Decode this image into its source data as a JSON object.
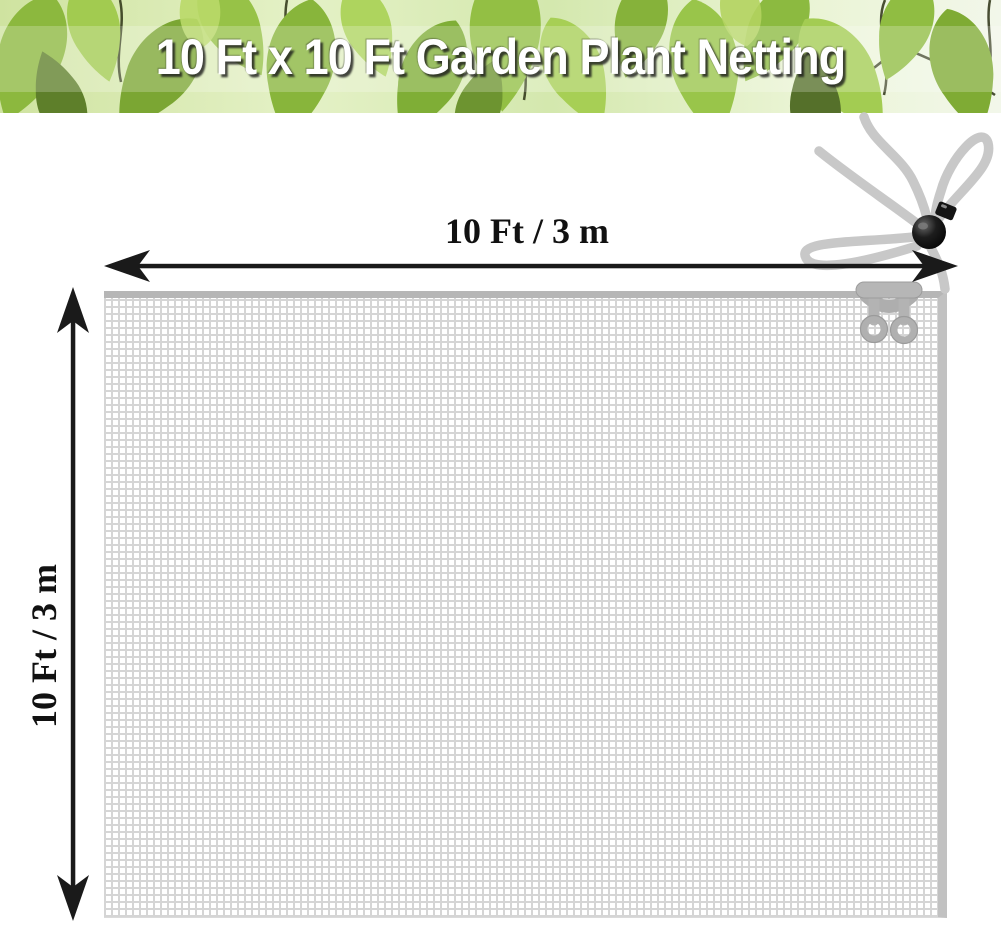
{
  "header": {
    "title": "10 Ft x 10 Ft Garden Plant Netting"
  },
  "dimensions": {
    "width_label": "10 Ft / 3 m",
    "height_label": "10 Ft / 3 m"
  },
  "icons": {
    "cord_lock": "cord-lock-toggle-icon",
    "net_clip": "double-ring-clip-icon",
    "tie_rope": "tie-rope-bow-icon",
    "width_arrow": "double-headed-horizontal-arrow",
    "height_arrow": "double-headed-vertical-arrow"
  },
  "colors": {
    "title_text": "#ffffff",
    "arrow": "#1a1a1a",
    "dimension_text": "#111111",
    "net_grid_line": "#d5d5d5",
    "net_edge_top": "#b6b6b6",
    "net_edge_right": "#c1c1c1",
    "rope": "#c8c8c8",
    "cord_lock": "#111111",
    "leaf_green_dark": "#7ba633",
    "leaf_green_mid": "#93bf44",
    "leaf_green_light": "#aed45e",
    "header_background": "#dcecbd"
  }
}
